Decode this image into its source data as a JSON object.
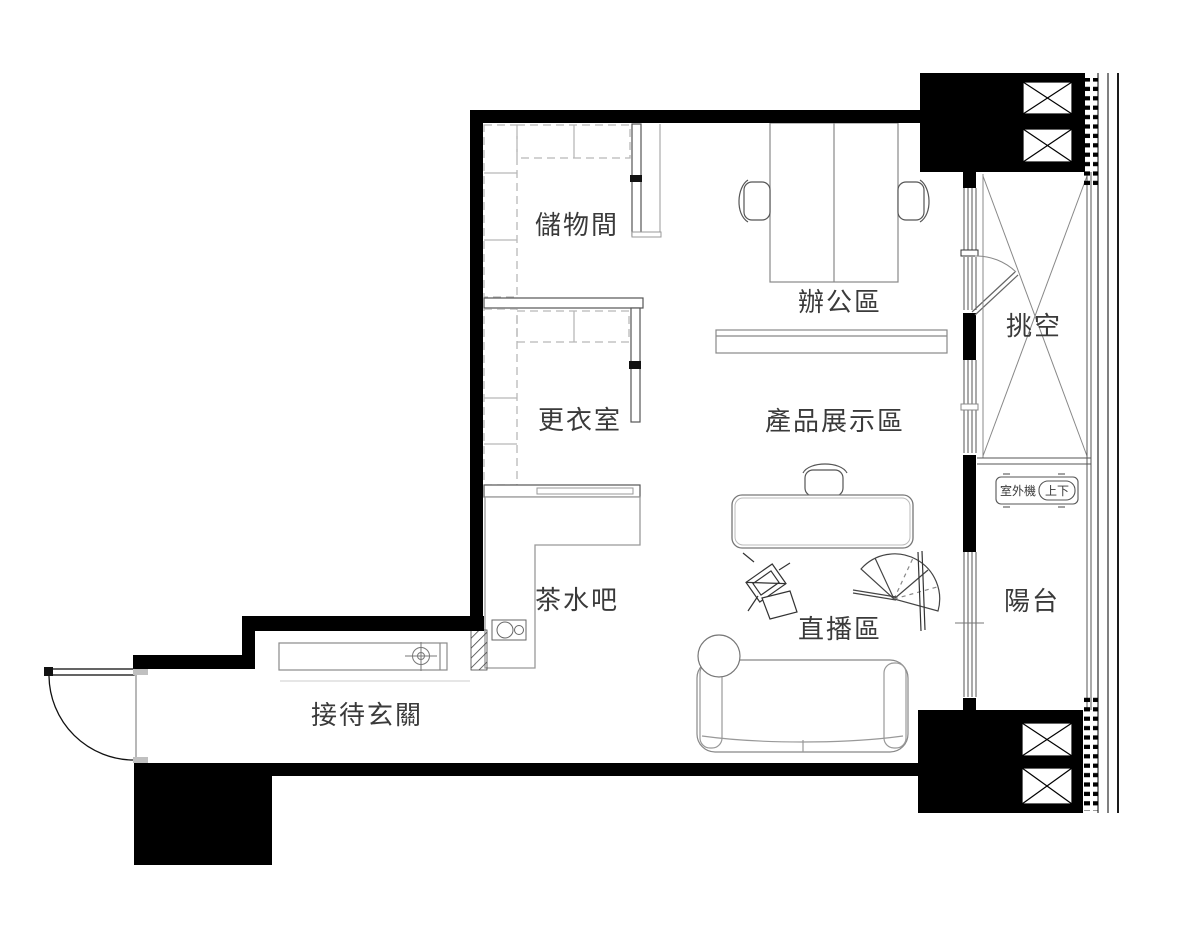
{
  "plan": {
    "rooms": {
      "storage": "儲物間",
      "office": "辦公區",
      "dressing": "更衣室",
      "display": "產品展示區",
      "tea_bar": "茶水吧",
      "live": "直播區",
      "entry": "接待玄關",
      "void": "挑空",
      "balcony": "陽台"
    },
    "annotations": {
      "outdoor_unit": "室外機",
      "outdoor_unit_mode": "上下"
    },
    "colors": {
      "wall": "#000000",
      "text": "#3a3a3a",
      "line_dark": "#555555",
      "line_mid": "#888888",
      "line_light": "#bbbbbb",
      "background": "#ffffff"
    }
  }
}
